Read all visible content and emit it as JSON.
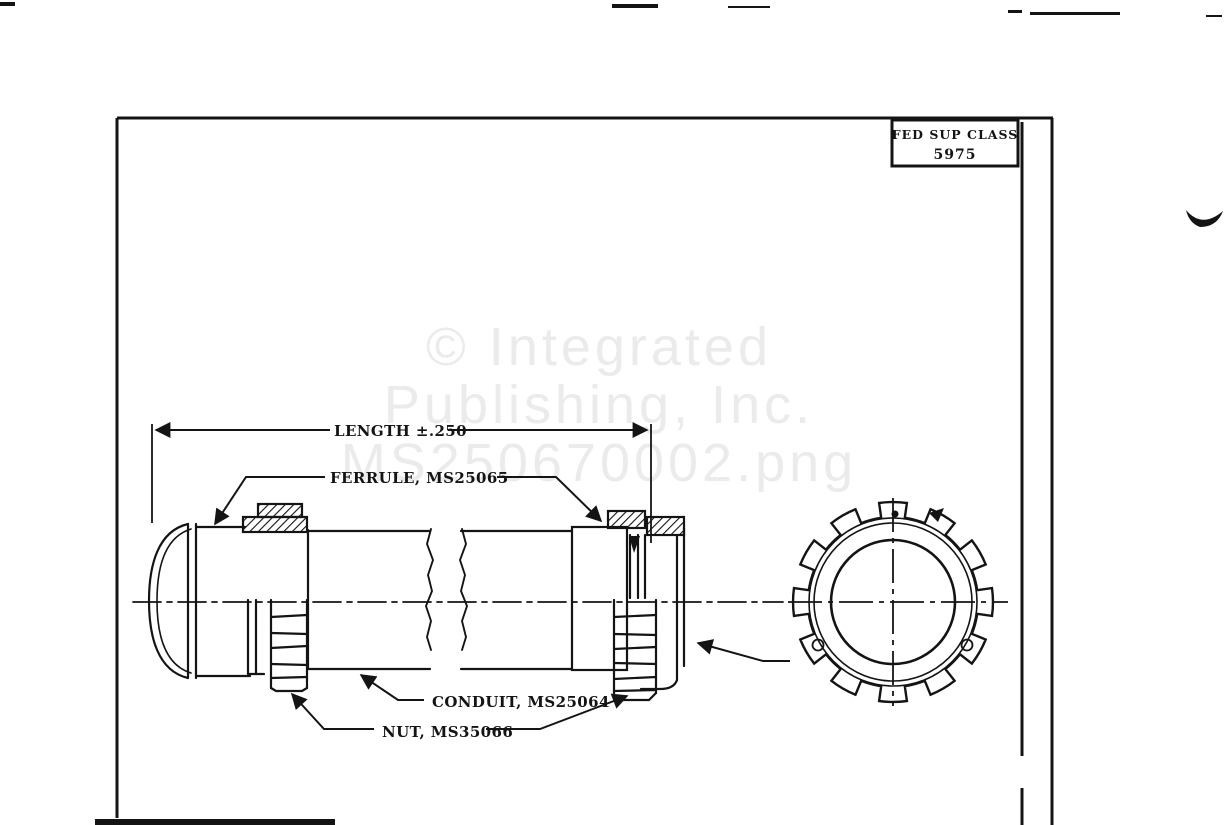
{
  "colors": {
    "ink": "#141414",
    "paper": "#ffffff",
    "watermark": "#ebebeb"
  },
  "header": {
    "fed_sup_class_label": "FED SUP CLASS",
    "fed_sup_class_value": "5975"
  },
  "watermark": {
    "line1": "© Integrated",
    "line2": "Publishing, Inc.",
    "line3": "MS250670002.png"
  },
  "figure": {
    "dimension_label": "LENGTH ±.250",
    "ferrule_label": "FERRULE, MS25065",
    "conduit_label": "CONDUIT, MS25064",
    "nut_label": "NUT, MS35066"
  }
}
